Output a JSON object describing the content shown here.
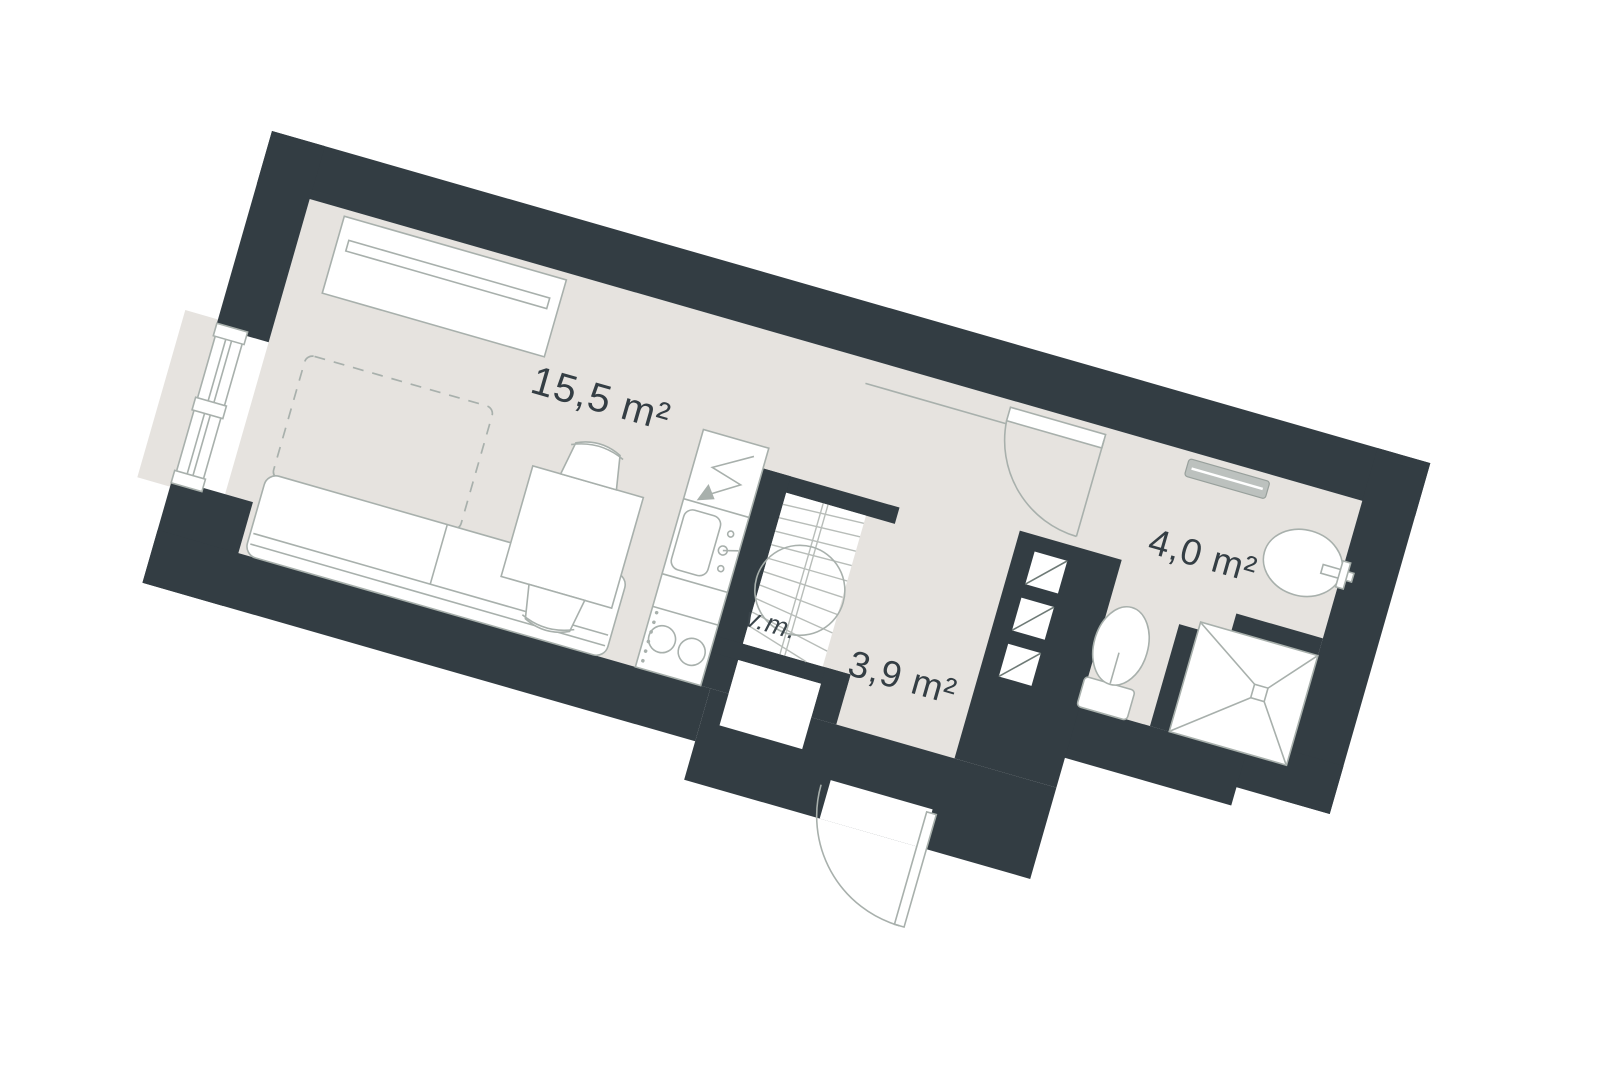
{
  "plan": {
    "type": "apartment-floor-plan",
    "rooms": {
      "living": {
        "area_label": "15,5 m²"
      },
      "hallway": {
        "area_label": "3,9 m²"
      },
      "bathroom": {
        "area_label": "4,0 m²"
      }
    },
    "annotations": {
      "stair_label": "v.m."
    },
    "colors": {
      "wall": "#333d43",
      "floor": "#e6e3df",
      "furniture_line": "#a8b0ac",
      "label_text": "#343e44",
      "radiator": "#bcc1be"
    }
  }
}
